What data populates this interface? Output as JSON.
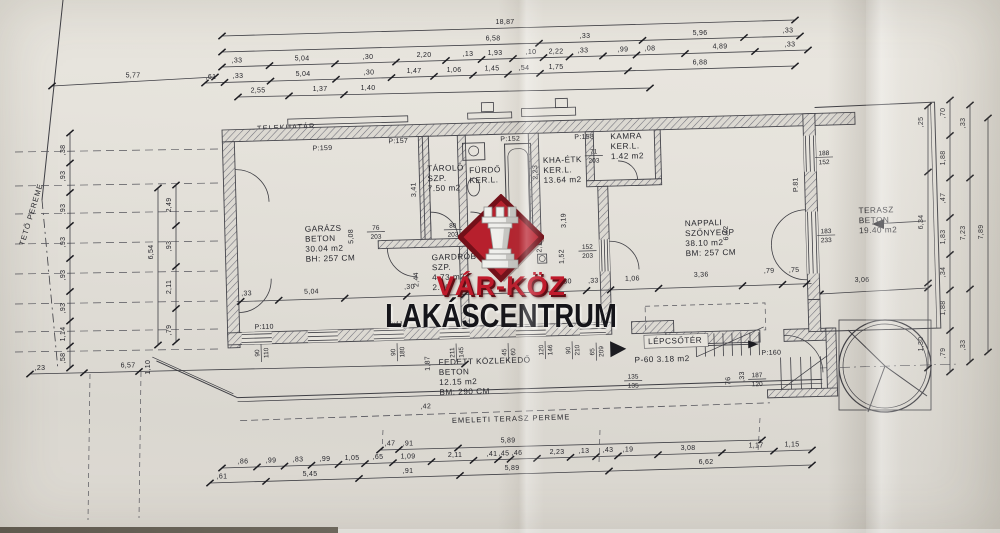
{
  "watermark": {
    "brand_top": "VÁR-KÖZ",
    "brand_bottom": "LAKÁSCENTRUM",
    "logo_icon": "chess-rook-icon",
    "colors": {
      "diamond": "#b7202d",
      "diamond_border": "#731019",
      "brand_top_color": "#c01a2b",
      "brand_bottom_color": "#15151a"
    }
  },
  "colors": {
    "paper": "#e6e3dc",
    "line": "#3e3e44",
    "dim_text": "#26262c"
  },
  "plan": {
    "boundary_labels": [
      {
        "text": "TELEKHATÁR",
        "x": 257,
        "y": 131,
        "rot": -2.5
      },
      {
        "text": "TETŐ PEREME",
        "x": 24,
        "y": 246,
        "rot": -73
      },
      {
        "text": "EMELETI TERASZ PEREME",
        "x": 452,
        "y": 423,
        "rot": -1.8
      }
    ],
    "rooms": [
      {
        "name": "garazs",
        "lines": [
          "GARÁZS",
          "BETON",
          "30.04 m2",
          "BH: 257 CM"
        ],
        "x": 80,
        "y": 104
      },
      {
        "name": "tarolo",
        "lines": [
          "TÁROLÓ",
          "SZP.",
          "7.50 m2"
        ],
        "x": 204,
        "y": 47
      },
      {
        "name": "furdo",
        "lines": [
          "FÜRDŐ",
          "KER.L."
        ],
        "x": 246,
        "y": 50
      },
      {
        "name": "kha-etk",
        "lines": [
          "KHA-ÉTK",
          "KER.L.",
          "13.64 m2"
        ],
        "x": 320,
        "y": 42
      },
      {
        "name": "kamra",
        "lines": [
          "KAMRA",
          "KER.L.",
          "1.42 m2"
        ],
        "x": 388,
        "y": 20
      },
      {
        "name": "nappali",
        "lines": [
          "NAPPALI",
          "SZŐNYEGP",
          "38.10 m2",
          "BM: 257 CM"
        ],
        "x": 460,
        "y": 109
      },
      {
        "name": "terasz",
        "lines": [
          "TERASZ",
          "BETON",
          "19.40 m2"
        ],
        "x": 634,
        "y": 101
      },
      {
        "name": "gardrob",
        "lines": [
          "GARDRÓB",
          "SZP.",
          "4.73 m2",
          "2.90"
        ],
        "x": 206,
        "y": 136
      },
      {
        "name": "fedett-kozlekedo",
        "lines": [
          "FEDETT KÖZLEKEDŐ",
          "BETON",
          "12.15 m2",
          "BM: 290 CM"
        ],
        "x": 210,
        "y": 241
      },
      {
        "name": "lepcsoter",
        "lines": [
          "LÉPCSŐTÉR"
        ],
        "x": 420,
        "y": 226
      },
      {
        "name": "lepcsoter-terulet",
        "lines": [
          "P-60  3.18 m2"
        ],
        "x": 406,
        "y": 244
      }
    ],
    "markers": [
      {
        "t": "P:159",
        "x": 90,
        "y": 23
      },
      {
        "t": "P:157",
        "x": 166,
        "y": 18
      },
      {
        "t": "P:152",
        "x": 278,
        "y": 19
      },
      {
        "t": "P:158",
        "x": 352,
        "y": 19
      },
      {
        "t": "P:110",
        "x": 27,
        "y": 200
      },
      {
        "t": "P:110",
        "x": 161,
        "y": 201
      },
      {
        "t": "P:160",
        "x": 533,
        "y": 240
      },
      {
        "t": "P.81",
        "x": 574,
        "y": 78,
        "rot": -90
      }
    ],
    "fractions": [
      {
        "a": "188",
        "b": "152",
        "x": 601,
        "y": 42
      },
      {
        "a": "183",
        "b": "233",
        "x": 601,
        "y": 120
      },
      {
        "a": "152",
        "b": "203",
        "x": 362,
        "y": 129
      },
      {
        "a": "76",
        "b": "203",
        "x": 151,
        "y": 104
      },
      {
        "a": "80",
        "b": "203",
        "x": 228,
        "y": 104
      },
      {
        "a": "71",
        "b": "203",
        "x": 371,
        "y": 34
      },
      {
        "a": "135",
        "b": "135",
        "x": 404,
        "y": 260
      },
      {
        "a": "187",
        "b": "120",
        "x": 528,
        "y": 262
      },
      {
        "a": "90",
        "b": "110",
        "x": 31,
        "y": 224,
        "rot": -90
      },
      {
        "a": "90",
        "b": "180",
        "x": 167,
        "y": 227,
        "rot": -90
      },
      {
        "a": "65",
        "b": "209",
        "x": 366,
        "y": 232,
        "rot": -90
      },
      {
        "a": "211",
        "b": "145",
        "x": 226,
        "y": 229,
        "rot": -90
      },
      {
        "a": "45",
        "b": "60",
        "x": 278,
        "y": 230,
        "rot": -90
      },
      {
        "a": "120",
        "b": "146",
        "x": 315,
        "y": 229,
        "rot": -90
      },
      {
        "a": "90",
        "b": "210",
        "x": 342,
        "y": 230,
        "rot": -90
      }
    ],
    "inner_dims": [
      {
        "t": ",33",
        "x": 20,
        "y": 166
      },
      {
        "t": "5,04",
        "x": 85,
        "y": 166
      },
      {
        "t": ",30",
        "x": 183,
        "y": 164
      },
      {
        "t": "2,30",
        "x": 338,
        "y": 163
      },
      {
        "t": ",33",
        "x": 367,
        "y": 163
      },
      {
        "t": "1,06",
        "x": 406,
        "y": 162
      },
      {
        "t": "3,36",
        "x": 475,
        "y": 160
      },
      {
        "t": ",79",
        "x": 543,
        "y": 158
      },
      {
        "t": ",75",
        "x": 568,
        "y": 158
      },
      {
        "t": "5,08",
        "x": 128,
        "y": 110,
        "rot": -90
      },
      {
        "t": "3,41",
        "x": 192,
        "y": 65,
        "rot": -90
      },
      {
        "t": "2,23",
        "x": 314,
        "y": 51,
        "rot": -90
      },
      {
        "t": "3,19",
        "x": 341,
        "y": 100,
        "rot": -90
      },
      {
        "t": "2,19",
        "x": 316,
        "y": 124,
        "rot": -90
      },
      {
        "t": "1,52",
        "x": 338,
        "y": 136,
        "rot": -90
      },
      {
        "t": "2,44",
        "x": 192,
        "y": 155,
        "rot": -90
      },
      {
        "t": "6,42",
        "x": 503,
        "y": 117,
        "rot": -90
      },
      {
        "t": "1,87",
        "x": 201,
        "y": 239,
        "rot": -90
      },
      {
        "t": ",76",
        "x": 501,
        "y": 266,
        "rot": -90
      },
      {
        "t": ",33",
        "x": 515,
        "y": 261,
        "rot": -90
      },
      {
        "t": ",42",
        "x": 196,
        "y": 284
      }
    ],
    "extra_dims": [
      {
        "t": "3,06",
        "x": 862,
        "y": 282
      }
    ],
    "dim_rows_top": [
      {
        "x1": 222,
        "y1": 36,
        "x2": 795,
        "y2": 20,
        "labels": [
          {
            "t": "18,87",
            "x": 505
          }
        ]
      },
      {
        "x1": 222,
        "y1": 52,
        "x2": 800,
        "y2": 36,
        "labels": [
          {
            "t": "6,58",
            "x": 493
          },
          {
            "t": ",33",
            "x": 585
          },
          {
            "t": "5,96",
            "x": 700
          },
          {
            "t": ",33",
            "x": 788
          }
        ]
      },
      {
        "x1": 222,
        "y1": 67,
        "x2": 808,
        "y2": 50,
        "labels": [
          {
            "t": ",33",
            "x": 237
          },
          {
            "t": "5,04",
            "x": 302
          },
          {
            "t": ",30",
            "x": 368
          },
          {
            "t": "2,20",
            "x": 424
          },
          {
            "t": ",13",
            "x": 468
          },
          {
            "t": "1,93",
            "x": 495
          },
          {
            "t": ",10",
            "x": 531
          },
          {
            "t": "2,22",
            "x": 556
          },
          {
            "t": ",33",
            "x": 583
          },
          {
            "t": ",99",
            "x": 623
          },
          {
            "t": ",08",
            "x": 650
          },
          {
            "t": "4,89",
            "x": 720
          },
          {
            "t": ",33",
            "x": 790
          }
        ]
      },
      {
        "x1": 205,
        "y1": 83,
        "x2": 795,
        "y2": 66,
        "labels": [
          {
            "t": ",61",
            "x": 211
          },
          {
            "t": ",33",
            "x": 238
          },
          {
            "t": "5,04",
            "x": 303
          },
          {
            "t": ",30",
            "x": 369
          },
          {
            "t": "1,47",
            "x": 414
          },
          {
            "t": "1,06",
            "x": 454
          },
          {
            "t": "1,45",
            "x": 492
          },
          {
            "t": ",54",
            "x": 524
          },
          {
            "t": "1,75",
            "x": 556
          },
          {
            "t": "6,88",
            "x": 700
          }
        ]
      },
      {
        "x1": 238,
        "y1": 97,
        "x2": 650,
        "y2": 88,
        "labels": [
          {
            "t": "2,55",
            "x": 258
          },
          {
            "t": "1,37",
            "x": 320
          },
          {
            "t": "1,40",
            "x": 368
          }
        ]
      },
      {
        "x1": 52,
        "y1": 86,
        "x2": 215,
        "y2": 77,
        "labels": [
          {
            "t": "5,77",
            "x": 133
          }
        ]
      }
    ],
    "dim_rows_bottom": [
      {
        "x1": 380,
        "y1": 450,
        "x2": 762,
        "y2": 440,
        "labels": [
          {
            "t": ",47",
            "x": 390
          },
          {
            "t": ",91",
            "x": 408
          },
          {
            "t": "5,89",
            "x": 508
          }
        ]
      },
      {
        "x1": 222,
        "y1": 468,
        "x2": 812,
        "y2": 450,
        "labels": [
          {
            "t": ",86",
            "x": 243
          },
          {
            "t": ",99",
            "x": 271
          },
          {
            "t": ",83",
            "x": 298
          },
          {
            "t": ",99",
            "x": 325
          },
          {
            "t": "1,05",
            "x": 352
          },
          {
            "t": ",65",
            "x": 378
          },
          {
            "t": "1,09",
            "x": 408
          },
          {
            "t": "2,11",
            "x": 455
          },
          {
            "t": ",41",
            "x": 492
          },
          {
            "t": ",45",
            "x": 504
          },
          {
            "t": ",46",
            "x": 517
          },
          {
            "t": "2,23",
            "x": 557
          },
          {
            "t": ",13",
            "x": 584
          },
          {
            "t": ",43",
            "x": 608
          },
          {
            "t": ",19",
            "x": 628
          },
          {
            "t": "3,08",
            "x": 688
          },
          {
            "t": "1,17",
            "x": 756
          },
          {
            "t": "1,15",
            "x": 792
          }
        ]
      },
      {
        "x1": 210,
        "y1": 483,
        "x2": 812,
        "y2": 465,
        "labels": [
          {
            "t": ",61",
            "x": 222
          },
          {
            "t": "5,45",
            "x": 310
          },
          {
            "t": ",91",
            "x": 408
          },
          {
            "t": "5,89",
            "x": 512
          },
          {
            "t": "6,62",
            "x": 706
          }
        ]
      },
      {
        "x1": 30,
        "y1": 374,
        "x2": 465,
        "y2": 364,
        "labels": [
          {
            "t": ",23",
            "x": 40
          },
          {
            "t": "6,57",
            "x": 128
          },
          {
            "t": "1,10",
            "x": 150,
            "rot": -90
          }
        ]
      }
    ],
    "dim_cols": [
      {
        "x": 70,
        "y1": 133,
        "y2": 368,
        "labels": [
          {
            "t": ",38",
            "y": 150
          },
          {
            "t": ",93",
            "y": 176
          },
          {
            "t": ",93",
            "y": 209
          },
          {
            "t": ",93",
            "y": 242
          },
          {
            "t": ",93",
            "y": 275
          },
          {
            "t": ",93",
            "y": 308
          },
          {
            "t": "1,14",
            "y": 334
          },
          {
            "t": ",58",
            "y": 358
          }
        ]
      },
      {
        "x": 176,
        "y1": 185,
        "y2": 342,
        "labels": [
          {
            "t": "2,49",
            "y": 205
          },
          {
            "t": ",93",
            "y": 246
          },
          {
            "t": "2,11",
            "y": 287
          },
          {
            "t": ",79",
            "y": 330
          }
        ]
      },
      {
        "x": 158,
        "y1": 188,
        "y2": 345,
        "labels": [
          {
            "t": "6,54",
            "y": 252
          }
        ]
      },
      {
        "x": 928,
        "y1": 106,
        "y2": 368,
        "labels": [
          {
            "t": ",25",
            "y": 122
          },
          {
            "t": "6,34",
            "y": 222
          },
          {
            "t": "1,30",
            "y": 344
          }
        ]
      },
      {
        "x": 950,
        "y1": 100,
        "y2": 372,
        "labels": [
          {
            "t": ",70",
            "y": 113
          },
          {
            "t": "1,88",
            "y": 158
          },
          {
            "t": ",47",
            "y": 198
          },
          {
            "t": "1,83",
            "y": 237
          },
          {
            "t": ",34",
            "y": 272
          },
          {
            "t": "1,88",
            "y": 308
          },
          {
            "t": ",79",
            "y": 353
          }
        ]
      },
      {
        "x": 970,
        "y1": 105,
        "y2": 362,
        "labels": [
          {
            "t": ",33",
            "y": 123
          },
          {
            "t": "7,23",
            "y": 233
          },
          {
            "t": ",33",
            "y": 345
          }
        ]
      },
      {
        "x": 988,
        "y1": 118,
        "y2": 352,
        "labels": [
          {
            "t": "7,89",
            "y": 232
          }
        ]
      }
    ]
  }
}
